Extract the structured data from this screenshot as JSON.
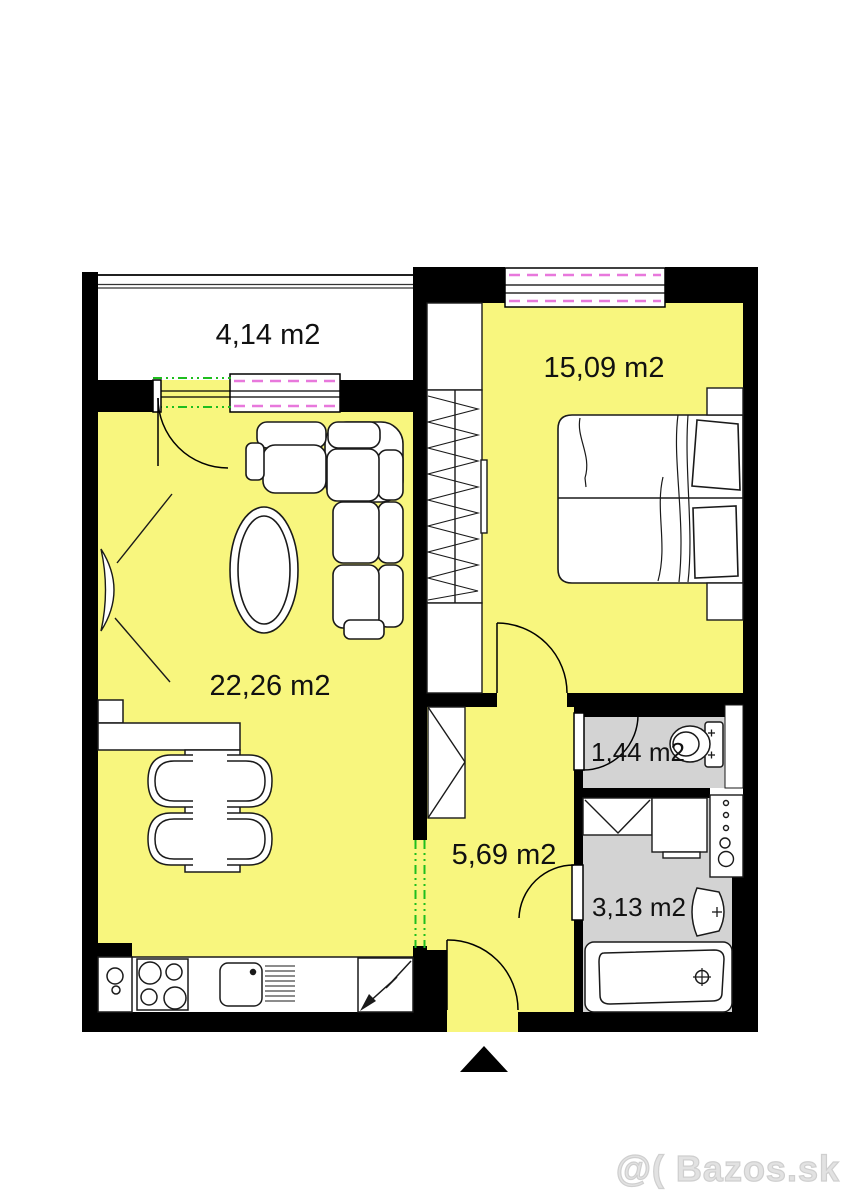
{
  "plan": {
    "type": "apartment-floor-plan",
    "rooms": [
      {
        "id": "balcony",
        "area_label": "4,14 m2"
      },
      {
        "id": "living-room",
        "area_label": "22,26 m2"
      },
      {
        "id": "bedroom",
        "area_label": "15,09 m2"
      },
      {
        "id": "hallway",
        "area_label": "5,69 m2"
      },
      {
        "id": "wc",
        "area_label": "1,44 m2"
      },
      {
        "id": "bathroom",
        "area_label": "3,13 m2"
      }
    ]
  },
  "watermark": {
    "text": "@( Bazos.sk"
  },
  "colors": {
    "room_fill": "#F8F67E",
    "wet_room_fill": "#D3D3D3",
    "wall": "#000000",
    "window_accent": "#E878DC",
    "opening_accent": "#1EBE1E",
    "watermark": "#DCDCDC"
  }
}
